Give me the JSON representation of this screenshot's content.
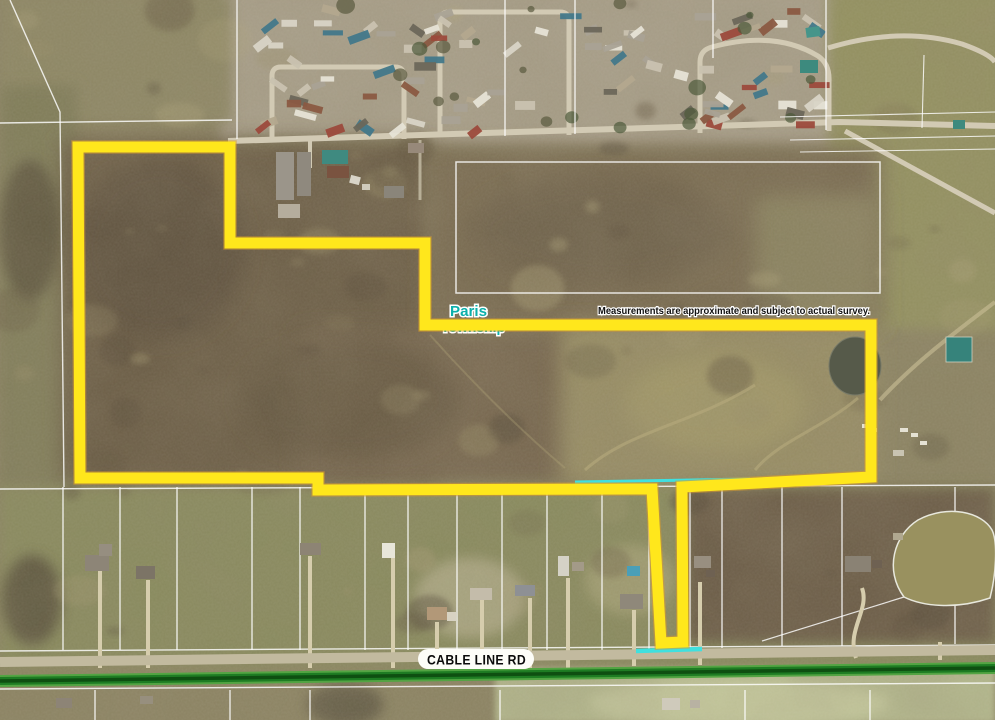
{
  "map": {
    "township_label": {
      "line1": "Paris",
      "line2": "Township"
    },
    "disclaimer_text": "Measurements are approximate and subject to actual survey.",
    "road_label": "CABLE LINE RD",
    "colors": {
      "boundary": "#ffe71c",
      "boundary_edge": "#d89b2b",
      "township_text": "#0cb0ab",
      "highlight": "#3fe0df",
      "road_green": "#1e7c23"
    },
    "boundary_points": [
      [
        78,
        147
      ],
      [
        230,
        147
      ],
      [
        230,
        243
      ],
      [
        425,
        243
      ],
      [
        425,
        325
      ],
      [
        871,
        325
      ],
      [
        871,
        477
      ],
      [
        682,
        487
      ],
      [
        683,
        642
      ],
      [
        661,
        643
      ],
      [
        652,
        489
      ],
      [
        318,
        490
      ],
      [
        318,
        478
      ],
      [
        80,
        478
      ]
    ]
  }
}
